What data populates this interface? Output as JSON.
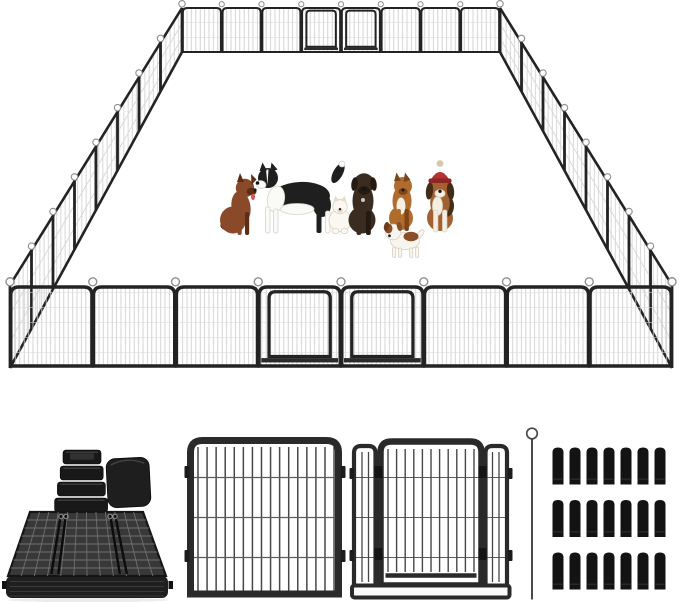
{
  "scene": {
    "type": "product-image",
    "subject": "Heavy duty metal dog playpen, 32 panels arranged as a large rectangle with two walk-through doors, 7 dogs inside, accessory detail shots below",
    "background": "#ffffff"
  },
  "palette": {
    "background": "#ffffff",
    "frame": "#232323",
    "frame_detail": "#2a2a2a",
    "mesh_line": "#c9c9c9",
    "mesh_cross": "#dadada",
    "loop": "#8f8f8f",
    "sill": "#2b2b2b",
    "shadow": "#ececec"
  },
  "playpen": {
    "panels_per_wall": 8,
    "total_panels": 32,
    "walls": [
      "back",
      "left",
      "right",
      "front"
    ],
    "front_doors": [
      3,
      4
    ],
    "back_doors": [
      3,
      4
    ],
    "stake_loop_on_every_post": true
  },
  "dogs": [
    {
      "id": "brown-dog-sitting",
      "description": "medium brown dog sitting, tongue out, facing right",
      "palette": {
        "main": "#8a4a2a",
        "dark": "#5c2e18",
        "nose": "#241710",
        "tongue": "#d95555"
      }
    },
    {
      "id": "border-collie-standing",
      "description": "black and white border collie standing, facing left",
      "palette": {
        "black": "#1f1f1f",
        "white": "#fafaf7",
        "wstroke": "#d3d3cd",
        "nose": "#121212"
      }
    },
    {
      "id": "white-pomeranian",
      "description": "small fluffy white dog sitting",
      "palette": {
        "white": "#fbf8f1",
        "stroke": "#d8d1c2",
        "face": "#e6ddcc",
        "nose": "#2b2118"
      }
    },
    {
      "id": "dark-mastiff-sitting",
      "description": "dark brown mastiff puppy sitting upright",
      "palette": {
        "main": "#3a2c21",
        "dark": "#241a12",
        "nose": "#141414",
        "tag": "#c9c9c9"
      }
    },
    {
      "id": "tan-dog-sitting",
      "description": "tan dog with white chest sitting",
      "palette": {
        "main": "#b06c2c",
        "dark": "#7c4418",
        "white": "#f6efe2",
        "nose": "#221910"
      }
    },
    {
      "id": "white-brown-puppy",
      "description": "small white puppy with brown patches standing",
      "palette": {
        "white": "#f8f5ee",
        "stroke": "#d8d1c2",
        "brown": "#8a4f28",
        "dark": "#6f3c1d",
        "nose": "#222222"
      }
    },
    {
      "id": "beagle-with-red-hat",
      "description": "tricolor beagle sitting wearing a red knit hat with pompom",
      "palette": {
        "brown": "#a36030",
        "dark": "#432c18",
        "white": "#f5efe3",
        "stroke": "#dcd3c2",
        "red": "#b23433",
        "redDark": "#8f2626",
        "pom": "#d9c9a8",
        "nose": "#1c1410"
      }
    }
  ],
  "accessories": {
    "corner_feet": {
      "stacked_caps": 4,
      "rubber_cover_cubes": 1,
      "cap_color": "#181818",
      "cube_color": "#1e1e1e"
    },
    "folded_panel_stack": {
      "description": "stack of folded fence panels lying flat",
      "grid_color": "#707070",
      "frame_color": "#1f1f1f"
    },
    "single_panel": {
      "vertical_bars": 16,
      "horizontal_wires": 3,
      "connector_tabs": 4,
      "frame_color": "#2a2a2a"
    },
    "door_panel": {
      "door_vertical_bars": 11,
      "side_strips": 2,
      "side_strip_bars": 2,
      "hinges": 2,
      "latches": 2,
      "base_rail": true,
      "frame_color": "#2a2a2a"
    },
    "ground_stake": {
      "count": 1,
      "loop_top": true,
      "color": "#414141"
    },
    "anchor_pegs": {
      "rows": 3,
      "columns": 7,
      "total": 21,
      "color": "#131313"
    }
  }
}
